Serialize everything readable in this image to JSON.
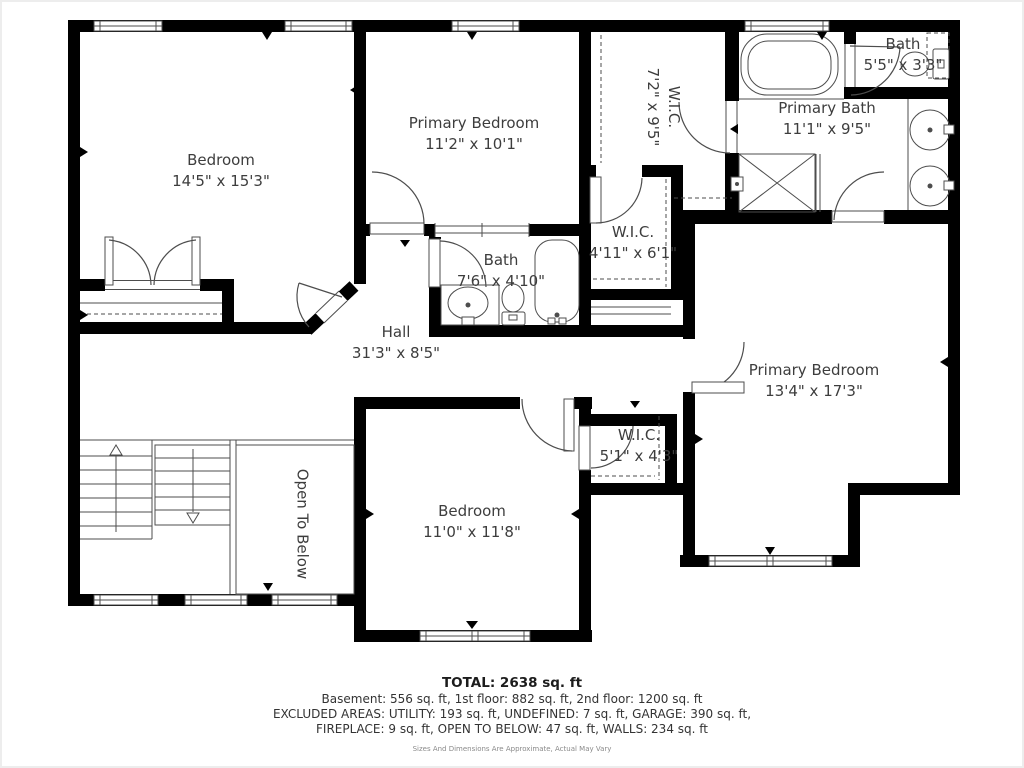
{
  "rooms": {
    "bedroom_top_left": {
      "name": "Bedroom",
      "dims": "14'5\" x 15'3\""
    },
    "primary_bedroom_top": {
      "name": "Primary Bedroom",
      "dims": "11'2\" x 10'1\""
    },
    "wic_top": {
      "name": "W.I.C.",
      "dims": "7'2\" x 9'5\""
    },
    "bath_small": {
      "name": "Bath",
      "dims": "5'5\" x 3'3\""
    },
    "primary_bath": {
      "name": "Primary Bath",
      "dims": "11'1\" x 9'5\""
    },
    "wic_mid": {
      "name": "W.I.C.",
      "dims": "4'11\" x 6'1\""
    },
    "hall": {
      "name": "Hall",
      "dims": "31'3\" x 8'5\""
    },
    "bath_mid": {
      "name": "Bath",
      "dims": "7'6\" x 4'10\""
    },
    "primary_bedroom_right": {
      "name": "Primary Bedroom",
      "dims": "13'4\" x 17'3\""
    },
    "wic_bottom": {
      "name": "W.I.C.",
      "dims": "5'1\" x 4'3\""
    },
    "bedroom_bottom": {
      "name": "Bedroom",
      "dims": "11'0\" x 11'8\""
    },
    "open_to_below": {
      "name": "Open To Below"
    }
  },
  "footer": {
    "total": "TOTAL: 2638 sq. ft",
    "line1": "Basement: 556 sq. ft, 1st floor: 882 sq. ft, 2nd floor: 1200 sq. ft",
    "line2": "EXCLUDED AREAS: UTILITY: 193 sq. ft, UNDEFINED: 7 sq. ft, GARAGE: 390 sq. ft,",
    "line3": "FIREPLACE: 9 sq. ft, OPEN TO BELOW: 47 sq. ft, WALLS: 234 sq. ft",
    "disclaimer": "Sizes And Dimensions Are Approximate, Actual May Vary"
  },
  "colors": {
    "wall": "#000000",
    "line": "#4d4d4d",
    "text": "#3d3d3d"
  }
}
